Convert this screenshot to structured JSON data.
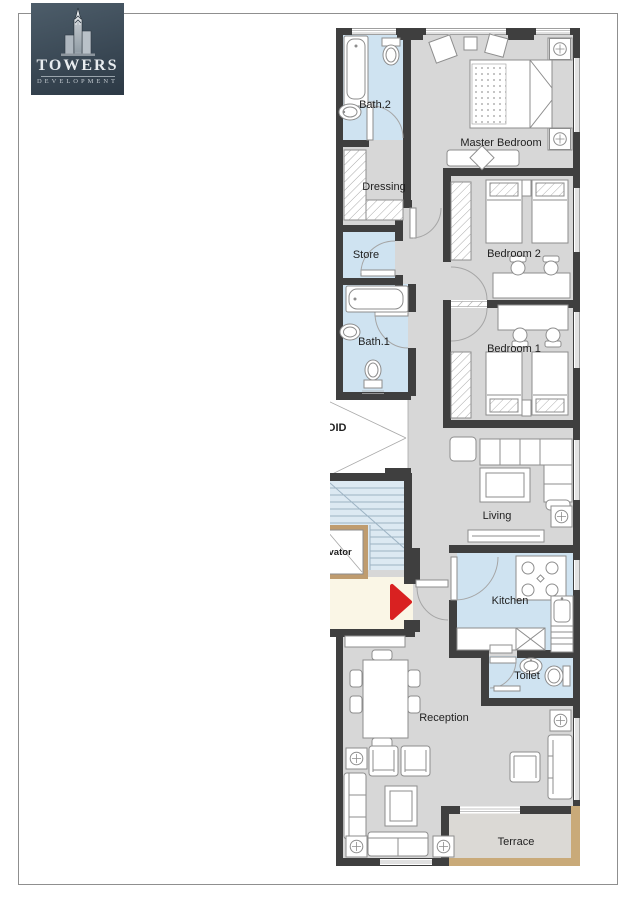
{
  "brand": {
    "name": "TOWERS",
    "tagline": "DEVELOPMENT"
  },
  "floorplan": {
    "rooms": [
      {
        "id": "bath2",
        "label": "Bath.2"
      },
      {
        "id": "master-bedroom",
        "label": "Master Bedroom"
      },
      {
        "id": "dressing",
        "label": "Dressing"
      },
      {
        "id": "store",
        "label": "Store"
      },
      {
        "id": "bedroom2",
        "label": "Bedroom 2"
      },
      {
        "id": "bath1",
        "label": "Bath.1"
      },
      {
        "id": "bedroom1",
        "label": "Bedroom 1"
      },
      {
        "id": "void",
        "label": "VOID"
      },
      {
        "id": "living",
        "label": "Living"
      },
      {
        "id": "elevator",
        "label": "Elevator"
      },
      {
        "id": "kitchen",
        "label": "Kitchen"
      },
      {
        "id": "toilet",
        "label": "Toilet"
      },
      {
        "id": "reception",
        "label": "Reception"
      },
      {
        "id": "terrace",
        "label": "Terrace"
      }
    ],
    "colors": {
      "wall": "#3f3f3f",
      "floor": "#d7d7d7",
      "wet_area": "#cfe3f1",
      "landing": "#faf6e6",
      "elevator_frame": "#bf9c6f",
      "terrace_border": "#c9aa79",
      "terrace_floor": "#dbd9d5",
      "entry_arrow": "#d92121"
    }
  }
}
